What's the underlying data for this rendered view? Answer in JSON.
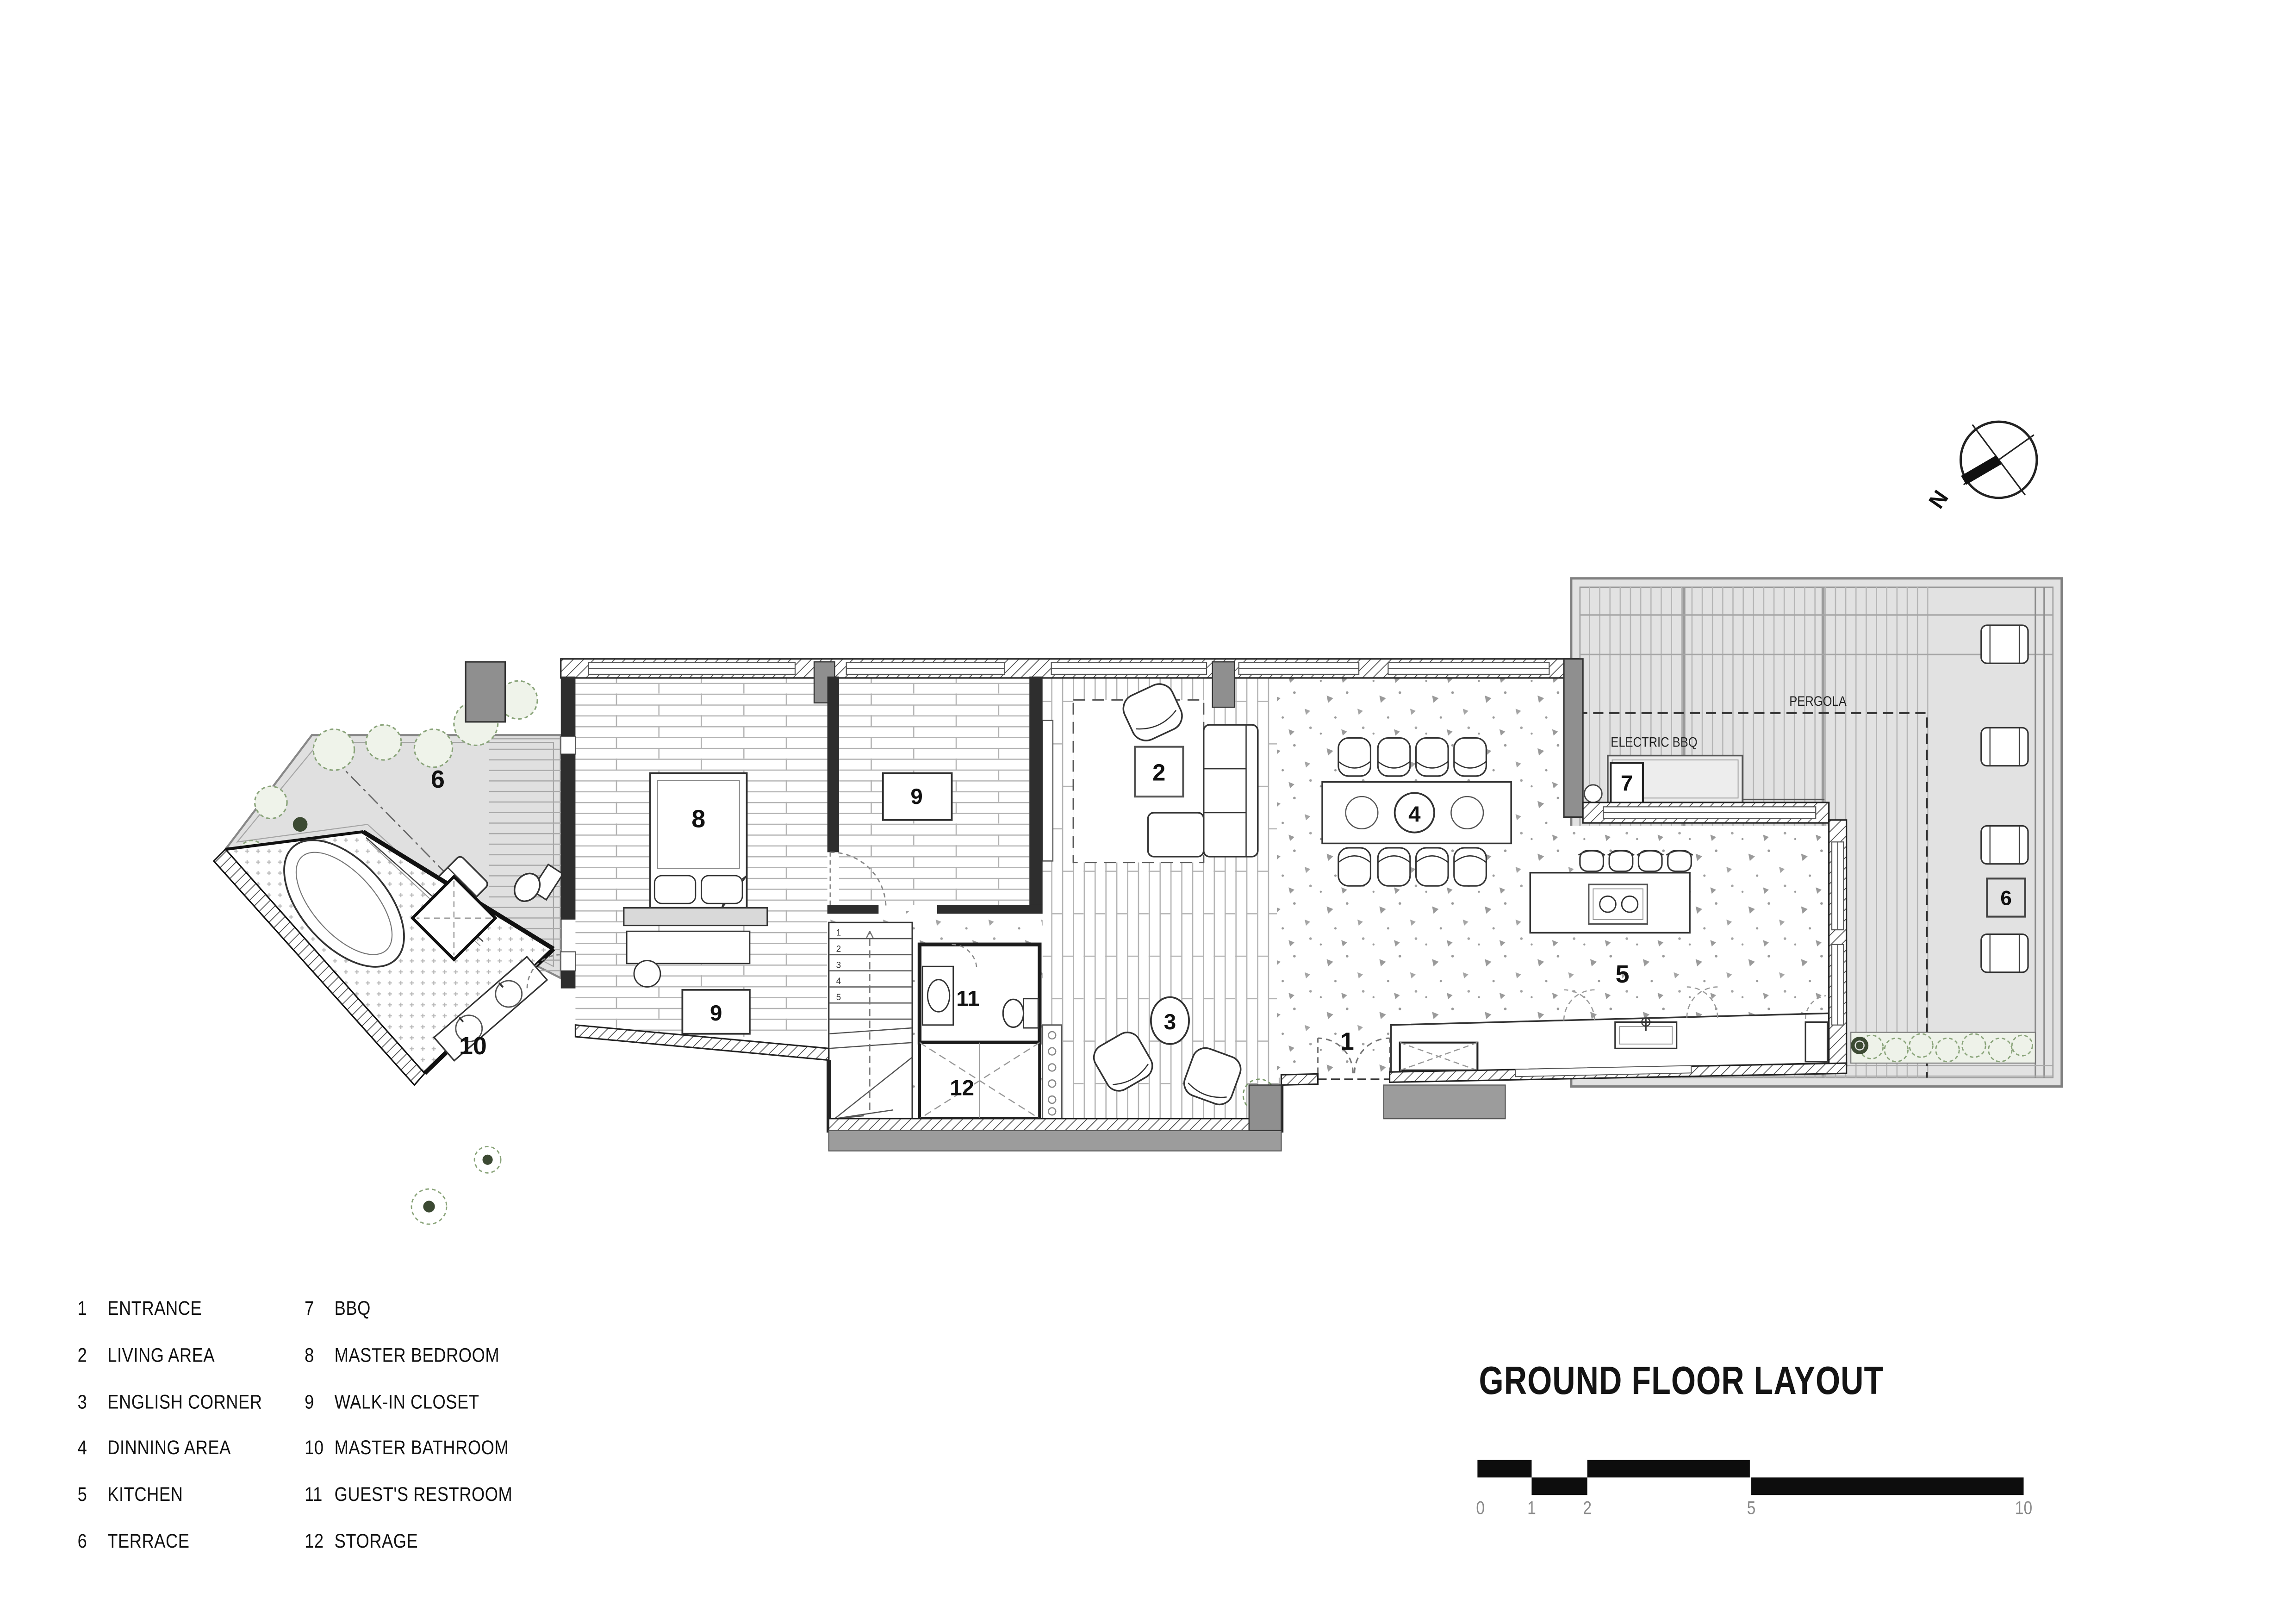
{
  "title": "GROUND FLOOR LAYOUT",
  "scale_bar": {
    "ticks": [
      "0",
      "1",
      "2",
      "5",
      "10"
    ]
  },
  "north_label": "N",
  "plan_labels": {
    "pergola": "PERGOLA",
    "electric_bbq": "ELECTRIC BBQ"
  },
  "rooms": {
    "entrance": {
      "num": "1"
    },
    "living_area": {
      "num": "2"
    },
    "english_corner": {
      "num": "3"
    },
    "dining_area": {
      "num": "4"
    },
    "kitchen": {
      "num": "5"
    },
    "terrace_left": {
      "num": "6"
    },
    "terrace_right": {
      "num": "6"
    },
    "bbq": {
      "num": "7"
    },
    "master_bedroom": {
      "num": "8"
    },
    "walkin_closet_top": {
      "num": "9"
    },
    "walkin_closet_bottom": {
      "num": "9"
    },
    "master_bathroom": {
      "num": "10"
    },
    "guests_restroom": {
      "num": "11"
    },
    "storage": {
      "num": "12"
    }
  },
  "stair_steps": [
    "1",
    "2",
    "3",
    "4",
    "5"
  ],
  "legend": {
    "col1": [
      {
        "num": "1",
        "label": "ENTRANCE"
      },
      {
        "num": "2",
        "label": "LIVING AREA"
      },
      {
        "num": "3",
        "label": "ENGLISH CORNER"
      },
      {
        "num": "4",
        "label": "DINNING AREA"
      },
      {
        "num": "5",
        "label": "KITCHEN"
      },
      {
        "num": "6",
        "label": "TERRACE"
      }
    ],
    "col2": [
      {
        "num": "7",
        "label": "BBQ"
      },
      {
        "num": "8",
        "label": "MASTER BEDROOM"
      },
      {
        "num": "9",
        "label": "WALK-IN CLOSET"
      },
      {
        "num": "10",
        "label": "MASTER BATHROOM"
      },
      {
        "num": "11",
        "label": "GUEST'S RESTROOM"
      },
      {
        "num": "12",
        "label": "STORAGE"
      }
    ]
  },
  "colors": {
    "wall": "#2e2e2e",
    "terrace_gray": "#e2e2e2",
    "column_gray": "#8f8f8f",
    "plant_green": "#8aa47a"
  }
}
